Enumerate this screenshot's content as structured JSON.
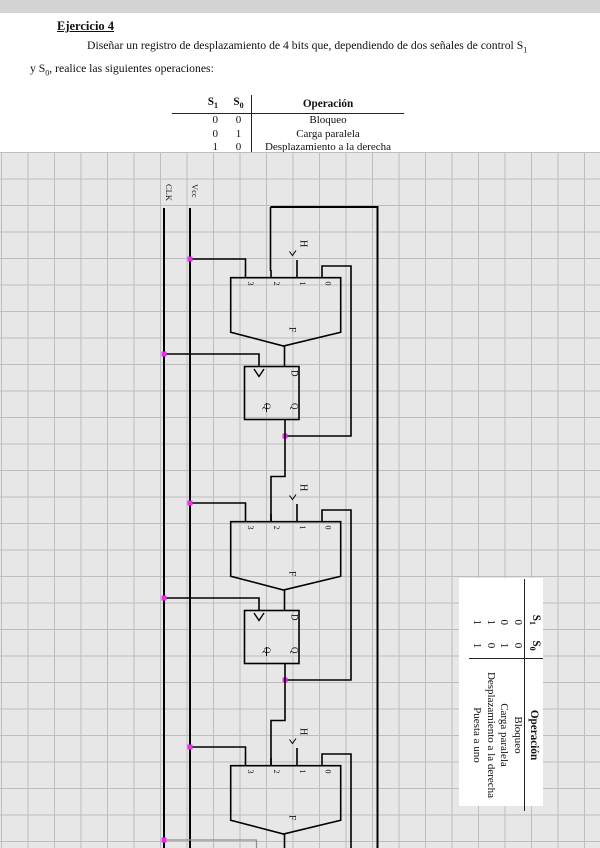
{
  "document": {
    "title": "Ejercicio 4",
    "paragraph_line1": "Diseñar un registro de desplazamiento de 4 bits que, dependiendo de dos señales de control S",
    "paragraph_line1_sub": "1",
    "paragraph_line2_pre": "y S",
    "paragraph_line2_sub": "0",
    "paragraph_line2_post": ", realice las siguientes operaciones:"
  },
  "op_table": {
    "header": {
      "s1_base": "S",
      "s1_sub": "1",
      "s0_base": "S",
      "s0_sub": "0",
      "operation": "Operación"
    },
    "rows": [
      {
        "s1": "0",
        "s0": "0",
        "op": "Bloqueo"
      },
      {
        "s1": "0",
        "s0": "1",
        "op": "Carga paralela"
      },
      {
        "s1": "1",
        "s0": "0",
        "op": "Desplazamiento a la derecha"
      },
      {
        "s1": "1",
        "s0": "1",
        "op": "Puesta a uno"
      }
    ]
  },
  "schematic": {
    "rails": {
      "clk_label": "CLK",
      "vcc_label": "Vcc"
    },
    "mux": {
      "pin_labels": [
        "3",
        "2",
        "1",
        "0"
      ],
      "body_label": "F"
    },
    "flipflop": {
      "d_label": "D",
      "q_label": "Q",
      "qbar_label": "Q"
    },
    "high_const_label": "H",
    "colors": {
      "wire": "#000000",
      "junction_dot": "#ee2dee",
      "grid_background": "#e7e7e7",
      "grid_line": "#bdbdbd"
    }
  }
}
